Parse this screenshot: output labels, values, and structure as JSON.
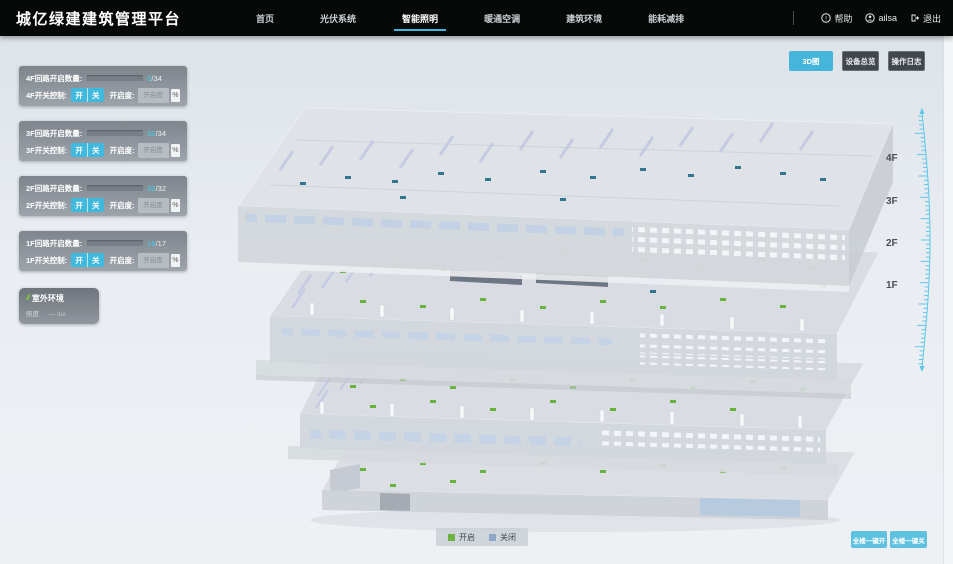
{
  "app": {
    "title": "城亿绿建建筑管理平台"
  },
  "nav": {
    "items": [
      {
        "label": "首页"
      },
      {
        "label": "光伏系统"
      },
      {
        "label": "智能照明"
      },
      {
        "label": "暖通空调"
      },
      {
        "label": "建筑环境"
      },
      {
        "label": "能耗减排"
      }
    ],
    "active_index": 2
  },
  "topbar_right": {
    "help": "帮助",
    "user": "ailsa",
    "logout": "退出"
  },
  "view_buttons": {
    "view_3d": "3D图",
    "device_overview": "设备总览",
    "operation_log": "操作日志"
  },
  "floor_panels": [
    {
      "circuit_label": "4F回路开启数量:",
      "open_count": "0",
      "total": "/34",
      "percent": 0,
      "switch_label": "4F开关控制:",
      "on_label": "开",
      "off_label": "关",
      "dim_label": "开启度:",
      "dim_placeholder": "开启度",
      "percent_suffix": "%"
    },
    {
      "circuit_label": "3F回路开启数量:",
      "open_count": "32",
      "total": "/34",
      "percent": 94,
      "switch_label": "3F开关控制:",
      "on_label": "开",
      "off_label": "关",
      "dim_label": "开启度:",
      "dim_placeholder": "开启度",
      "percent_suffix": "%"
    },
    {
      "circuit_label": "2F回路开启数量:",
      "open_count": "32",
      "total": "/32",
      "percent": 100,
      "switch_label": "2F开关控制:",
      "on_label": "开",
      "off_label": "关",
      "dim_label": "开启度:",
      "dim_placeholder": "开启度",
      "percent_suffix": "%"
    },
    {
      "circuit_label": "1F回路开启数量:",
      "open_count": "16",
      "total": "/17",
      "percent": 94,
      "switch_label": "1F开关控制:",
      "on_label": "开",
      "off_label": "关",
      "dim_label": "开启度:",
      "dim_placeholder": "开启度",
      "percent_suffix": "%"
    }
  ],
  "outdoor": {
    "title": "室外环境",
    "metric": "照度",
    "value": "— lux"
  },
  "floor_labels": [
    "4F",
    "3F",
    "2F",
    "1F"
  ],
  "legend": {
    "on": "开启",
    "off": "关闭"
  },
  "bulk_buttons": {
    "all_on": "全楼一键开",
    "all_off": "全楼一键关"
  },
  "colors": {
    "accent": "#41b9dd",
    "progress_fill": "#38c4e8",
    "legend_on": "#6cb33f",
    "legend_off": "#8fa6c4",
    "marker_on": "#69b33c",
    "marker_off": "#31758e"
  }
}
